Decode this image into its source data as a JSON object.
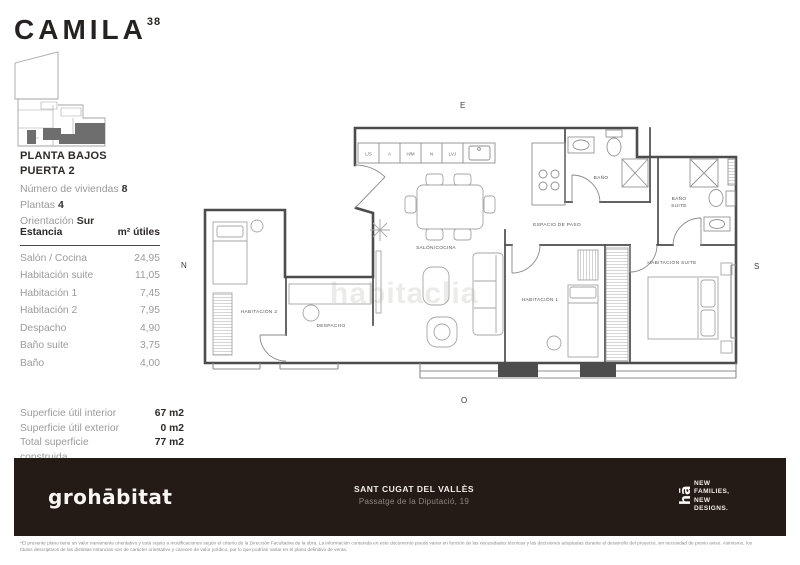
{
  "brand": {
    "name": "CAMILA",
    "superscript": "38"
  },
  "plan_header": {
    "line1": "PLANTA BAJOS",
    "line2": "PUERTA 2"
  },
  "plan_details": [
    {
      "label": "Número de viviendas",
      "value": "8"
    },
    {
      "label": "Plantas",
      "value": "4"
    },
    {
      "label": "Orientación",
      "value": "Sur"
    }
  ],
  "rooms_table": {
    "col_room": "Estancia",
    "col_area": "m² útiles",
    "rows": [
      {
        "name": "Salón / Cocina",
        "area": "24,95"
      },
      {
        "name": "Habitación suite",
        "area": "11,05"
      },
      {
        "name": "Habitación 1",
        "area": "7,45"
      },
      {
        "name": "Habitación 2",
        "area": "7,95"
      },
      {
        "name": "Despacho",
        "area": "4,90"
      },
      {
        "name": "Baño suite",
        "area": "3,75"
      },
      {
        "name": "Baño",
        "area": "4,00"
      }
    ]
  },
  "surface_summary": [
    {
      "label": "Superficie útil interior",
      "value": "67 m2"
    },
    {
      "label": "Superficie útil exterior",
      "value": "0 m2"
    },
    {
      "label": "Total superficie construida",
      "value": "77 m2"
    }
  ],
  "floorplan": {
    "compass": {
      "top": "E",
      "left": "N",
      "right": "S",
      "bottom": "O"
    },
    "watermark": "habitaclia",
    "labels": {
      "salon": "SALÓN/COCINA",
      "espacio": "ESPACIO DE PASO",
      "hab1": "HABITACIÓN 1",
      "hab2": "HABITACIÓN 2",
      "despacho": "DESPACHO",
      "bano": "BAÑO",
      "bano_suite_1": "BAÑO",
      "bano_suite_2": "SUITE",
      "hab_suite": "HABITACIÓN SUITE"
    },
    "kitchen_units": [
      "L/S",
      "A",
      "H/M",
      "N",
      "LVJ"
    ]
  },
  "footer": {
    "logo": "grohābitat",
    "location": "SANT CUGAT DEL VALLÈS",
    "address": "Passatge de la Diputació, 19",
    "tagline_logo": "hā",
    "tagline": [
      "NEW",
      "FAMILIES,",
      "NEW",
      "DESIGNS."
    ]
  },
  "disclaimer": {
    "line1": "*El presente plano tiene un valor meramente orientativo y está sujeto a modificaciones según el criterio de la Dirección Facultativa de la obra.  La información contenida en este documento puede variar en función de las necesidades técnicas y las decisiones adoptadas durante el desarrollo del proyecto, sin necesidad de previo aviso.  Asimismo, los",
    "line2": "títulos descriptivos de las distintas estancias son de carácter orientativo y carecen de valor jurídico, por lo que podrían variar en el plano definitivo de venta."
  }
}
